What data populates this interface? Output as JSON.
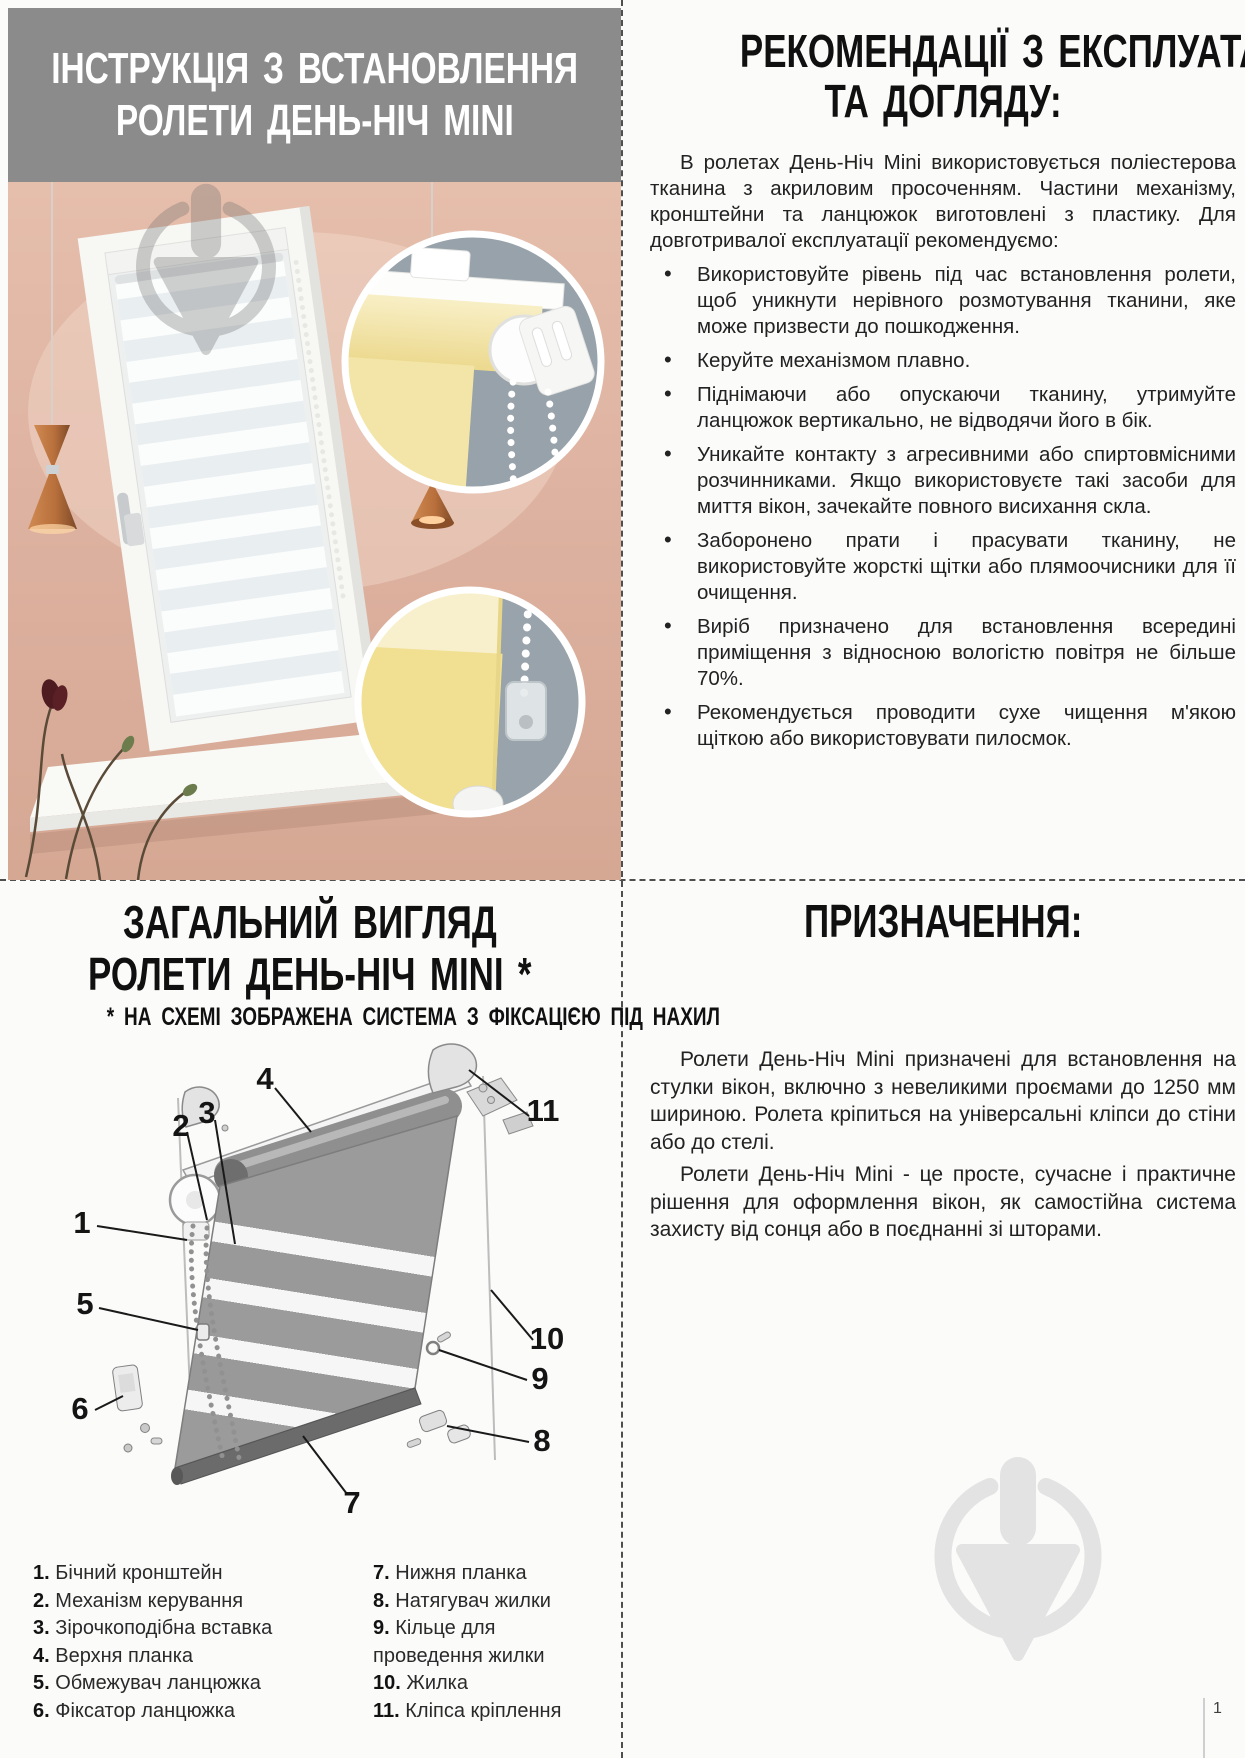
{
  "page": {
    "number": "1"
  },
  "colors": {
    "header_gray": "#8b8b8b",
    "wall_pink": "#ddb2a0",
    "blind_yellow": "#f2e3a3",
    "inset_gray": "#97a2aa",
    "watermark_gray": "#e3e3e3"
  },
  "install": {
    "title_line1": "ІНСТРУКЦІЯ З ВСТАНОВЛЕННЯ",
    "title_line2": "РОЛЕТИ ДЕНЬ-НІЧ MINI"
  },
  "care": {
    "title_line1": "РЕКОМЕНДАЦІЇ З ЕКСПЛУАТАЦІЇ",
    "title_line2": "ТА ДОГЛЯДУ:",
    "intro": "В ролетах День-Ніч Mini використовується поліестерова тканина з акриловим просоченням. Частини механізму, кронштейни та ланцюжок виготовлені з пластику. Для довготривалої експлуатації рекомендуємо:",
    "bullets": [
      "Використовуйте рівень під час встановлення ролети, щоб уникнути нерівного розмотування тканини, яке може призвести до пошкодження.",
      "Керуйте механізмом плавно.",
      "Піднімаючи або опускаючи тканину, утримуйте ланцюжок вертикально, не відводячи його в бік.",
      "Уникайте контакту з агресивними або спиртовмісними розчинниками. Якщо використовуєте такі засоби для миття вікон, зачекайте повного висихання скла.",
      "Заборонено прати і прасувати тканину, не використовуйте жорсткі щітки або плямоочисники для її очищення.",
      "Виріб призначено для встановлення всередині приміщення з відносною вологістю повітря не більше 70%.",
      "Рекомендується проводити сухе чищення м'якою щіткою або використовувати пилосмок."
    ]
  },
  "overview": {
    "title_line1": "ЗАГАЛЬНИЙ ВИГЛЯД",
    "title_line2": "РОЛЕТИ ДЕНЬ-НІЧ MINI *",
    "note": "* НА СХЕМІ ЗОБРАЖЕНА СИСТЕМА З ФІКСАЦІЄЮ ПІД НАХИЛ",
    "callouts": [
      "1",
      "2",
      "3",
      "4",
      "5",
      "6",
      "7",
      "8",
      "9",
      "10",
      "11"
    ],
    "legend_left": [
      {
        "num": "1.",
        "label": "Бічний кронштейн"
      },
      {
        "num": "2.",
        "label": "Механізм керування"
      },
      {
        "num": "3.",
        "label": "Зірочкоподібна вставка"
      },
      {
        "num": "4.",
        "label": "Верхня планка"
      },
      {
        "num": "5.",
        "label": "Обмежувач ланцюжка"
      },
      {
        "num": "6.",
        "label": "Фіксатор ланцюжка"
      }
    ],
    "legend_right": [
      {
        "num": "7.",
        "label": "Нижня планка"
      },
      {
        "num": "8.",
        "label": "Натягувач жилки"
      },
      {
        "num": "9.",
        "label": "Кільце для проведення жилки"
      },
      {
        "num": "10.",
        "label": "Жилка"
      },
      {
        "num": "11.",
        "label": "Кліпса кріплення"
      }
    ]
  },
  "purpose": {
    "title": "ПРИЗНАЧЕННЯ:",
    "p1": "Ролети День-Ніч Mini призначені для встановлення на стулки вікон, включно з невеликими проємами до 1250 мм шириною. Ролета кріпиться на універсальні кліпси до стіни або до стелі.",
    "p2": "Ролети День-Ніч Mini - це просте, сучасне і практичне рішення для оформлення вікон, як самостійна система захисту від сонця або в поєднанні зі шторами."
  }
}
